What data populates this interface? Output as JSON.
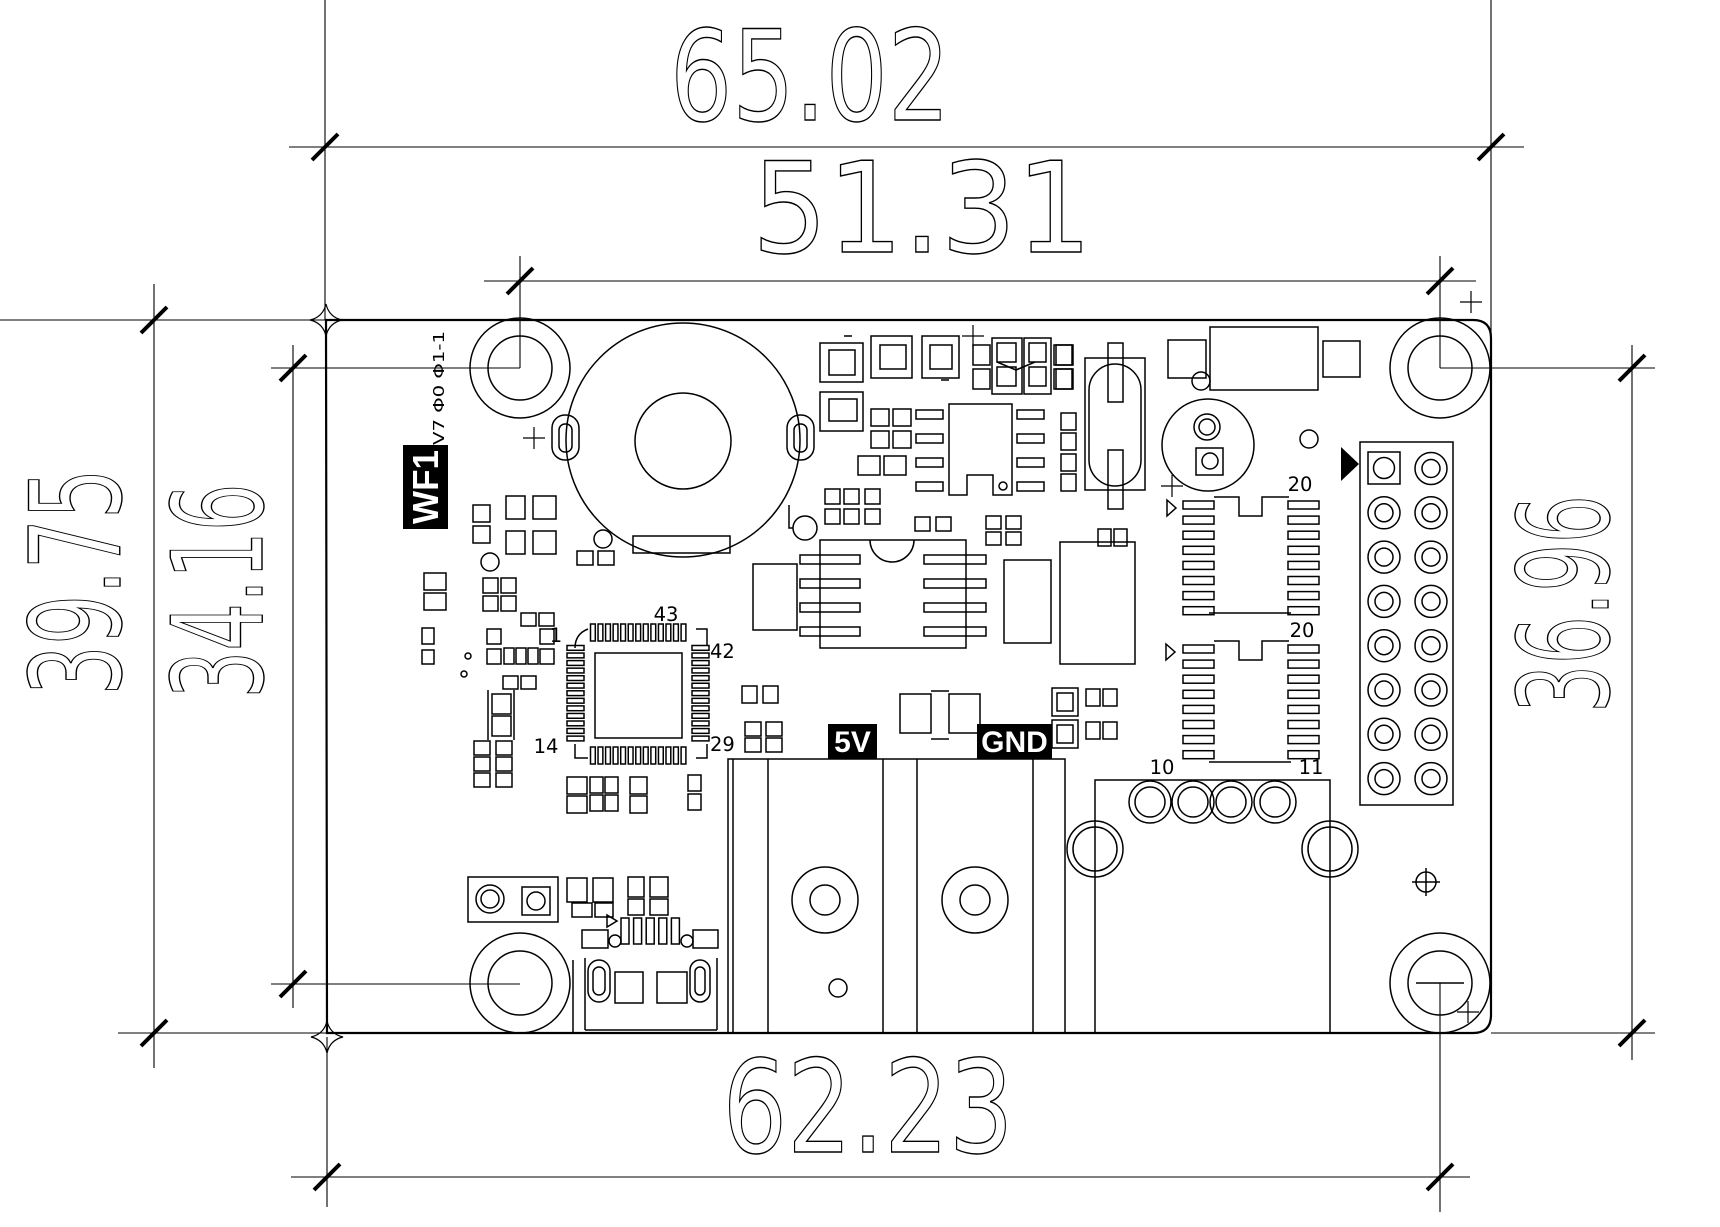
{
  "colors": {
    "background": "#ffffff",
    "line": "#000000",
    "label_bg": "#000000",
    "label_fg": "#ffffff"
  },
  "dimensions": {
    "top_outer": "65.02",
    "top_inner": "51.31",
    "left_outer": "39.75",
    "left_inner": "34.16",
    "right_side": "36.96",
    "bottom": "62.23"
  },
  "silkscreen": {
    "model": "WF1",
    "version": "V7 Φ0 Φ1-1",
    "power_left": "5V",
    "power_right": "GND"
  },
  "pins": {
    "qfp_1": "1",
    "qfp_14": "14",
    "qfp_29": "29",
    "qfp_42": "42",
    "qfp_43": "43",
    "ic_upper": "20",
    "ic_lower": "20",
    "hole_left": "10",
    "hole_right": "11"
  }
}
